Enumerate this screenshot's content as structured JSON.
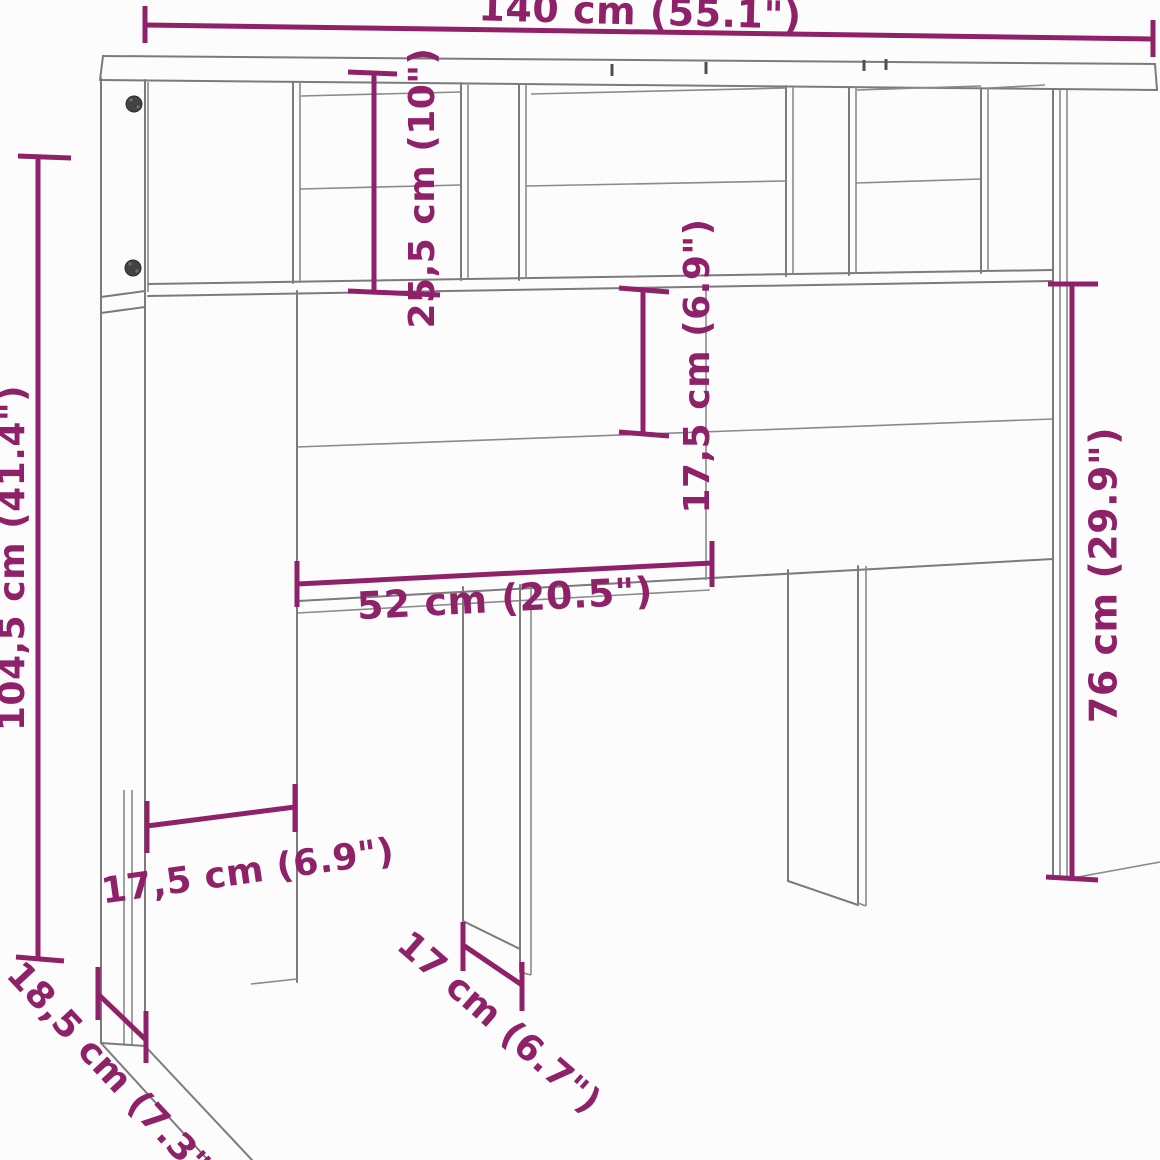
{
  "diagram": {
    "title": "Headboard cabinet dimension drawing",
    "colors": {
      "dimension_accent": "#8e2168",
      "outline_gray": "#7b7b7b",
      "background": "#fdfcfc"
    },
    "dimensions": {
      "total_width": "140 cm (55.1\")",
      "total_height": "104,5 cm (41.4\")",
      "top_shelf_height": "25,5 cm (10\")",
      "mid_panel_height": "17,5 cm (6.9\")",
      "panel_width": "52 cm (20.5\")",
      "lower_section_height": "76 cm (29.9\")",
      "left_leg_width": "17,5 cm (6.9\")",
      "base_foot_depth": "18,5 cm (7.3\")",
      "center_leg_depth": "17 cm (6.7\")"
    }
  }
}
